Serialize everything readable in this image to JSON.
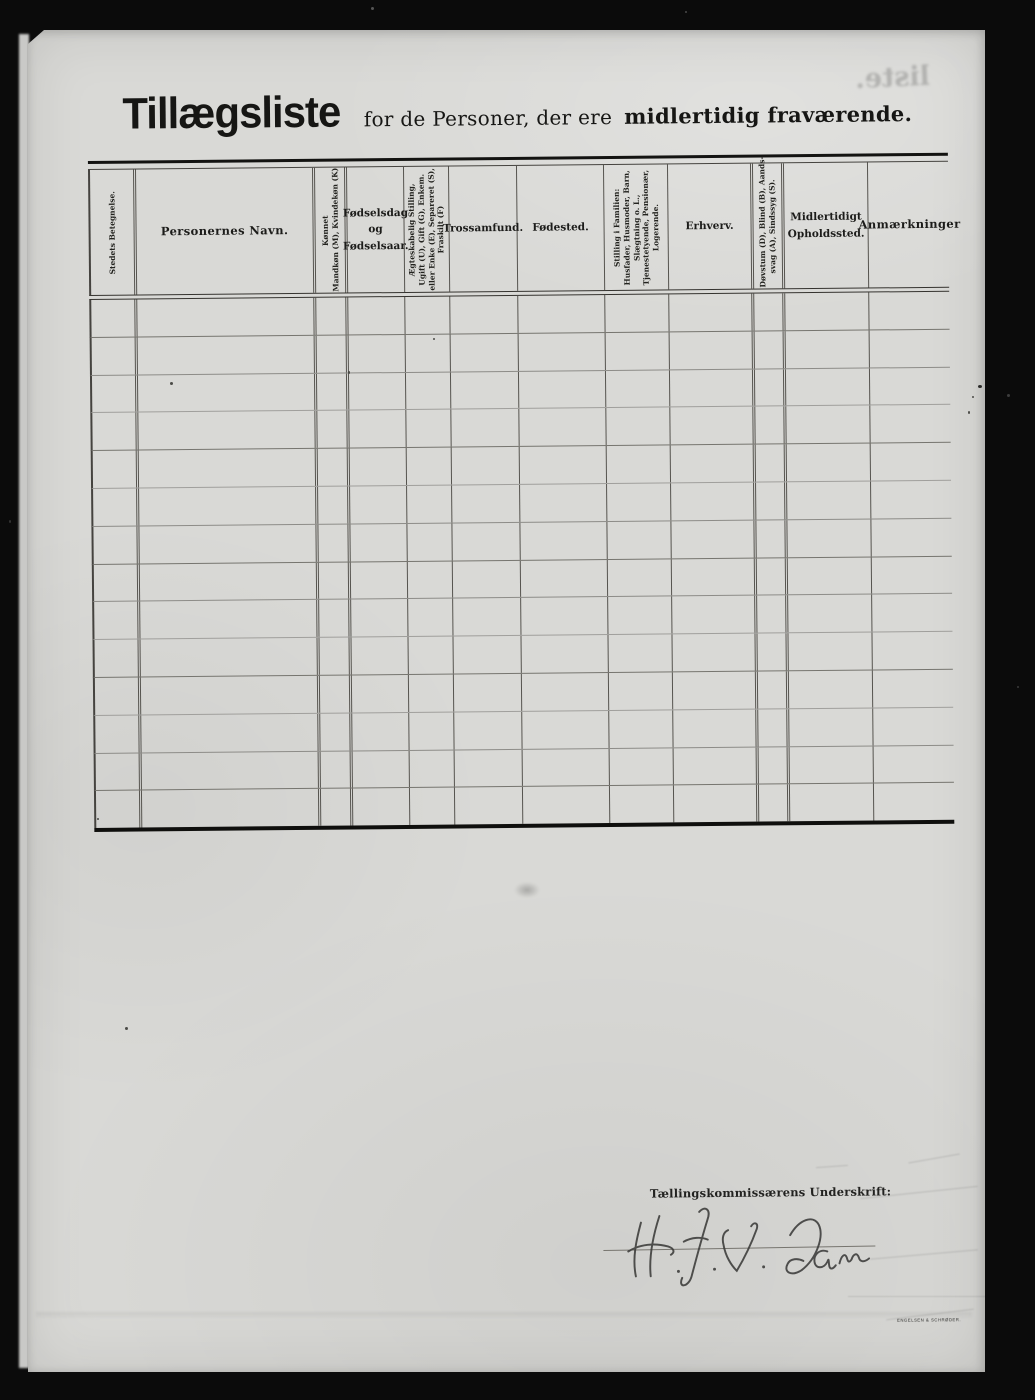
{
  "title": {
    "main": "Tillægsliste",
    "mid": "for de Personer, der ere",
    "bold2": "midlertidig fraværende."
  },
  "table": {
    "row_count": 14,
    "columns": [
      {
        "id": "stedets-betegnelse",
        "orientation": "vertical",
        "lines": [
          "Stedets Betegnelse."
        ]
      },
      {
        "id": "personernes-navn",
        "orientation": "horizontal",
        "lines": [
          "Personernes Navn."
        ]
      },
      {
        "id": "konnet",
        "orientation": "vertical",
        "lines": [
          "Kønnet",
          "Mandkøn (M), Kvindekøn (K)"
        ]
      },
      {
        "id": "fodselsdag",
        "orientation": "horizontal",
        "lines": [
          "Fødselsdag",
          "og",
          "Fødselsaar."
        ]
      },
      {
        "id": "aegteskabelig",
        "orientation": "vertical",
        "lines": [
          "Ægteskabelig Stilling,",
          "Ugift (U), Gift (G), Enkem.",
          "eller Enke (E), Separeret (S),",
          "Fraskilt (F)"
        ]
      },
      {
        "id": "trossamfund",
        "orientation": "horizontal",
        "lines": [
          "Trossamfund."
        ]
      },
      {
        "id": "fodested",
        "orientation": "horizontal",
        "lines": [
          "Fødested."
        ]
      },
      {
        "id": "stilling-i-familien",
        "orientation": "vertical",
        "lines": [
          "Stilling i Familien:",
          "Husfader, Husmoder, Barn,",
          "Slægtning o. L.,",
          "Tjenestetyende, Pensionær,",
          "Logerende."
        ]
      },
      {
        "id": "erhverv",
        "orientation": "horizontal",
        "lines": [
          "Erhverv."
        ]
      },
      {
        "id": "dovstum",
        "orientation": "vertical",
        "lines": [
          "Døvstum (D), Blind (B), Aands-",
          "svag (A), Sindssyg (S)."
        ]
      },
      {
        "id": "midlertidigt",
        "orientation": "horizontal",
        "lines": [
          "Midlertidigt",
          "Opholdssted."
        ]
      },
      {
        "id": "anmaerkninger",
        "orientation": "horizontal",
        "lines": [
          "Anmærkninger"
        ]
      }
    ]
  },
  "footer": {
    "signature_label": "Tællingskommissærens Underskrift:",
    "signature_name": "H. J. V. Dam"
  },
  "artifacts": {
    "bleed_text": "liste.",
    "printer_mark": "ENGELSEN & SCHRØDER.",
    "ink_color": "#1c1c1a",
    "paper_color": "#d9d9d6",
    "background_color": "#0b0b0b"
  }
}
